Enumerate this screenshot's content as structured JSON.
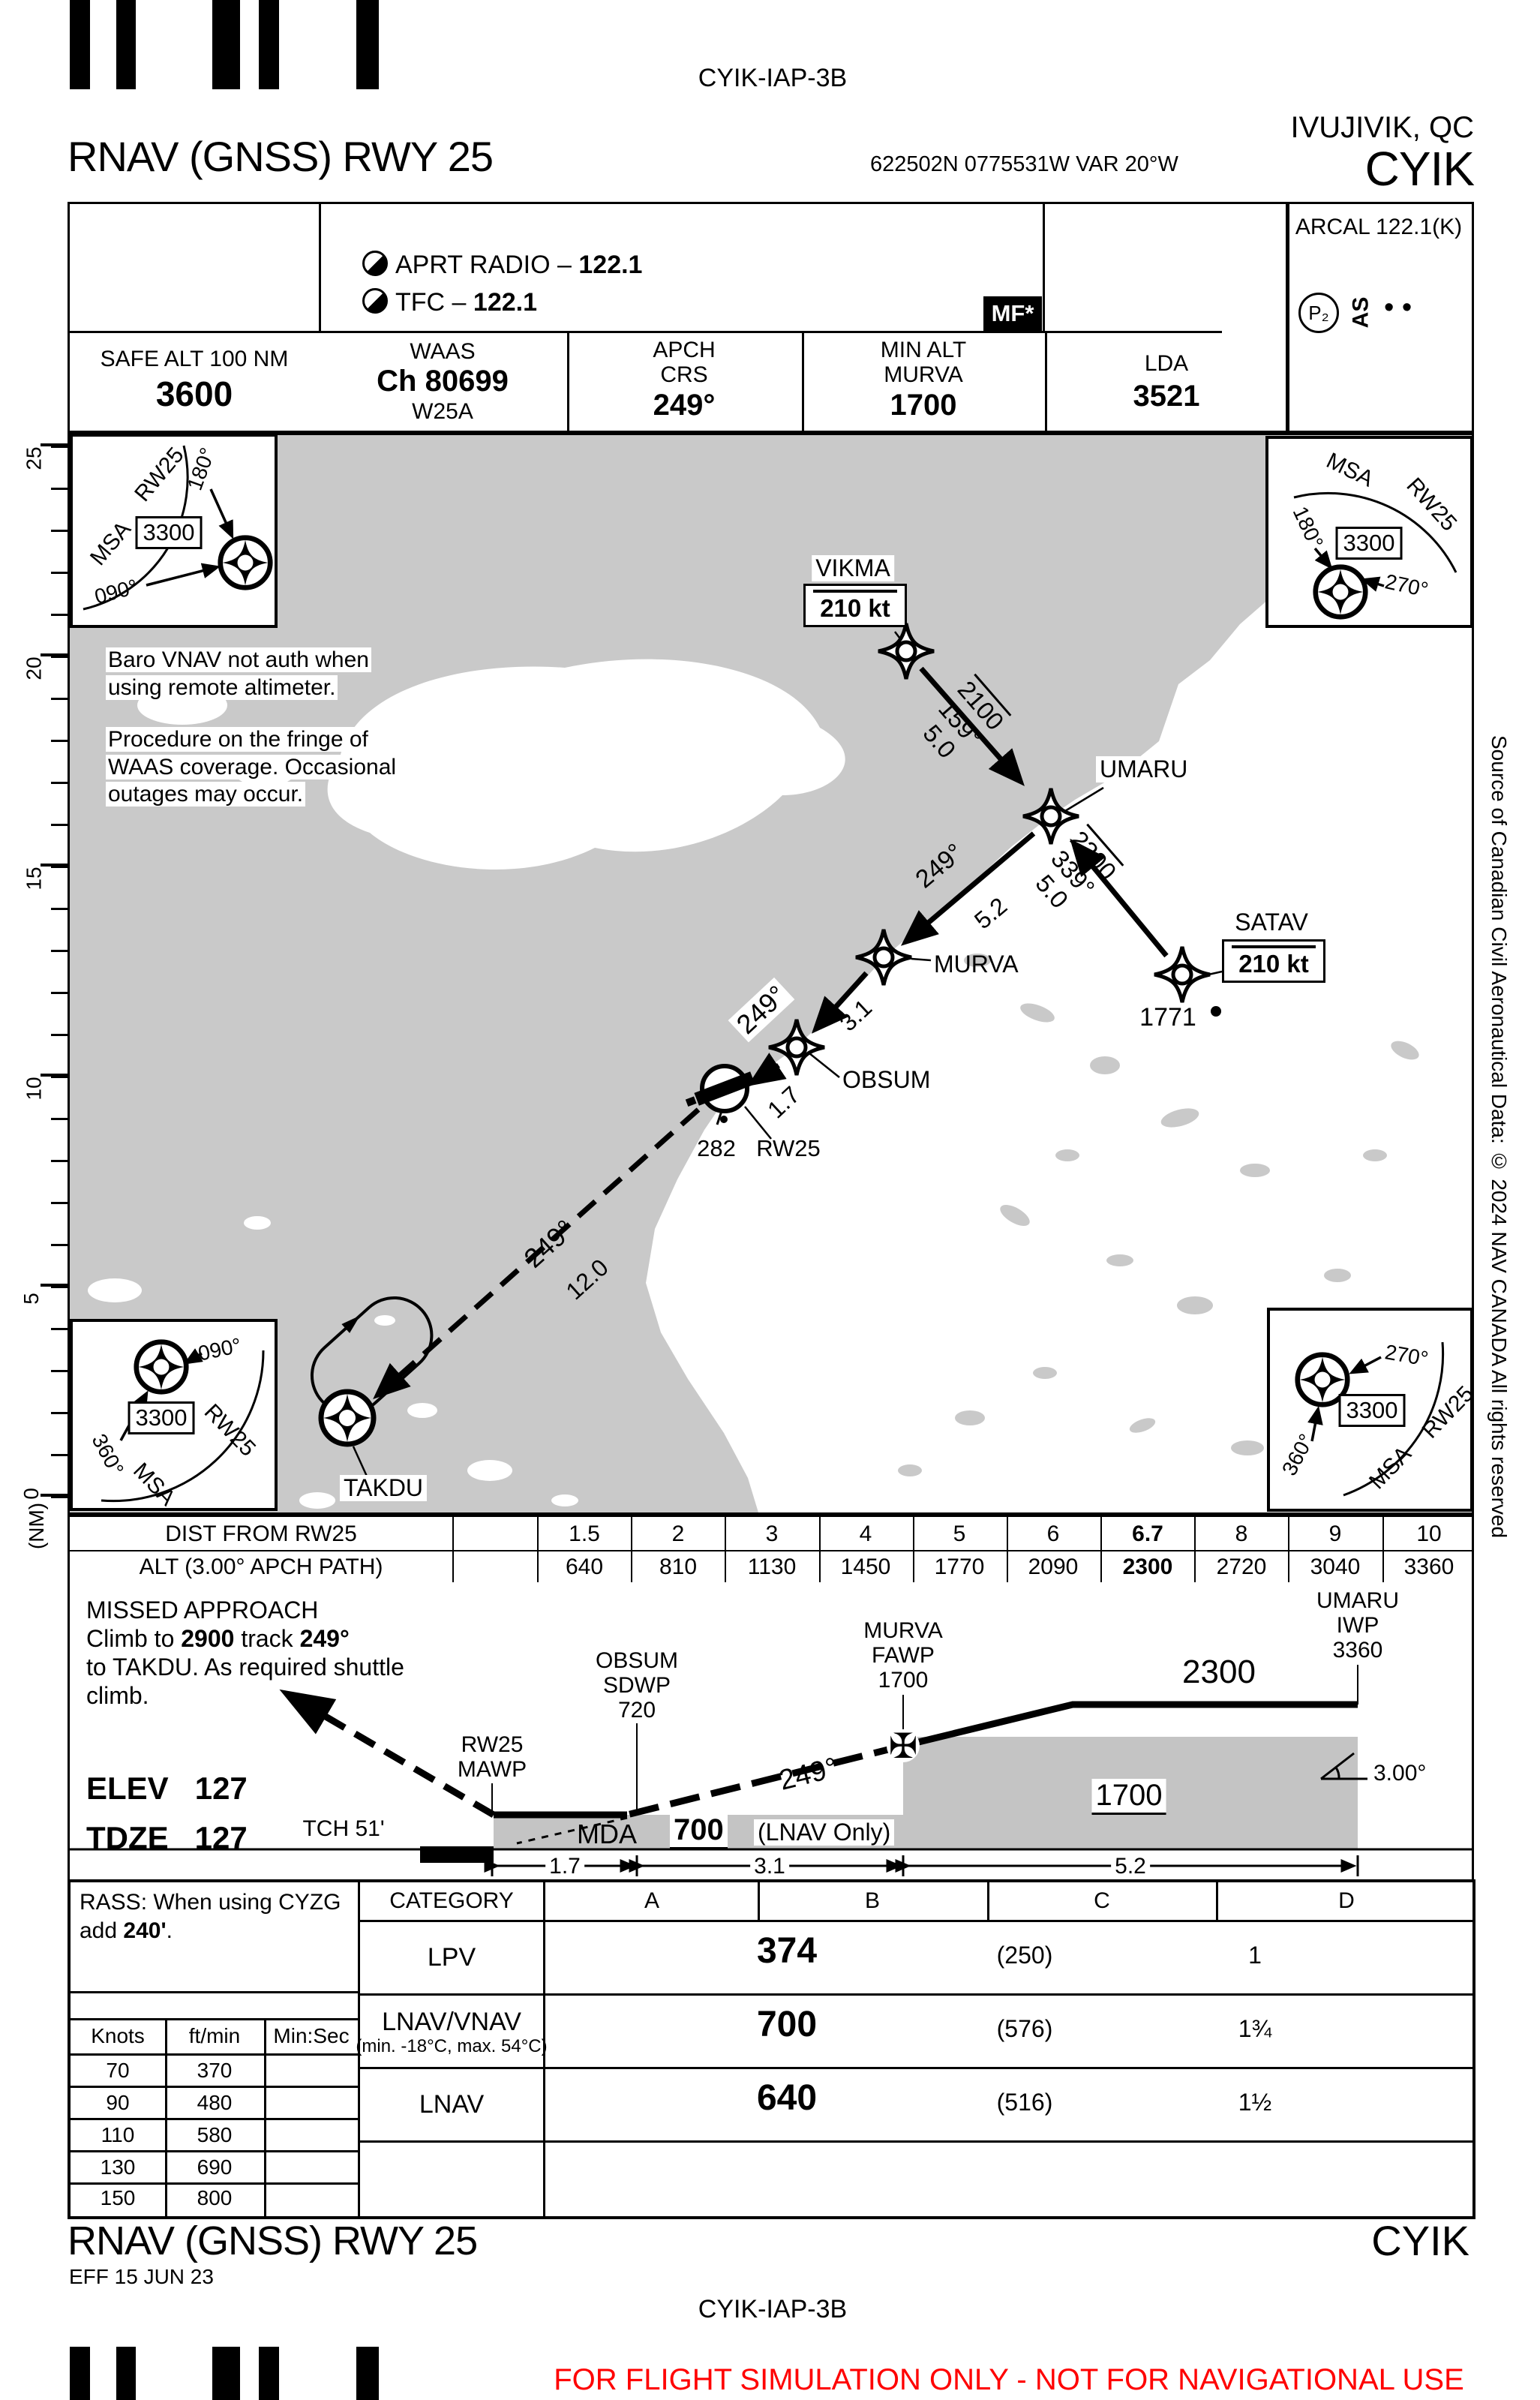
{
  "doc": {
    "top_code": "CYIK-IAP-3B",
    "city": "IVUJIVIK, QC",
    "icao": "CYIK",
    "procedure": "RNAV (GNSS) RWY 25",
    "coords": "622502N  0775531W  VAR 20°W"
  },
  "header_table": {
    "comm1_label": "APRT RADIO – ",
    "comm1_freq": "122.1",
    "comm2_label": "TFC – ",
    "comm2_freq": "122.1",
    "mf": "MF*",
    "arcal": "ARCAL 122.1(K)",
    "p2": "P₂",
    "as": "AS",
    "dots": "• •",
    "safe_label": "SAFE ALT 100 NM",
    "safe_value": "3600",
    "waas_label": "WAAS",
    "waas_ch": "Ch 80699",
    "waas_id": "W25A",
    "apch_l1": "APCH",
    "apch_l2": "CRS",
    "apch_value": "249°",
    "minalt_l1": "MIN ALT",
    "minalt_l2": "MURVA",
    "minalt_value": "1700",
    "lda_label": "LDA",
    "lda_value": "3521"
  },
  "plan": {
    "msa": {
      "title": "MSA",
      "rwy": "RW25",
      "alt": "3300",
      "tl": {
        "b1": "180°",
        "b2": "090°"
      },
      "tr": {
        "b1": "180°",
        "b2": "270°"
      },
      "bl": {
        "b1": "090°",
        "b2": "360°"
      },
      "br": {
        "b1": "270°",
        "b2": "360°"
      }
    },
    "notes": {
      "n1a": "Baro VNAV not auth when",
      "n1b": "using remote altimeter.",
      "n2a": "Procedure on the fringe of",
      "n2b": "WAAS coverage. Occasional",
      "n2c": "outages may occur."
    },
    "wpts": {
      "vikma": "VIKMA",
      "umaru": "UMARU",
      "murva": "MURVA",
      "obsum": "OBSUM",
      "satav": "SATAV",
      "takdu": "TAKDU"
    },
    "speed_restriction": "210 kt",
    "legs": {
      "vikma_umaru": {
        "alt": "2100",
        "crs": "159°",
        "dist": "5.0"
      },
      "satav_umaru": {
        "alt": "2300",
        "crs": "339°",
        "dist": "5.0"
      },
      "umaru_murva": {
        "crs": "249°",
        "dist": "5.2"
      },
      "murva_obsum": {
        "dist": "3.1"
      },
      "obsum_rw": {
        "crs": "249°",
        "dist": "1.7"
      },
      "missed": {
        "crs": "249°",
        "dist": "12.0"
      }
    },
    "rw_label": "RW25",
    "spot_rw": "282",
    "spot_satav": "1771",
    "scale": {
      "unit": "(NM)",
      "l0": "0",
      "l5": "5",
      "l10": "10",
      "l15": "15",
      "l20": "20",
      "l25": "25"
    }
  },
  "dist_table": {
    "r1": "DIST FROM RW25",
    "r2": "ALT (3.00°  APCH PATH)",
    "d": [
      "1.5",
      "2",
      "3",
      "4",
      "5",
      "6",
      "6.7",
      "8",
      "9",
      "10"
    ],
    "a": [
      "640",
      "810",
      "1130",
      "1450",
      "1770",
      "2090",
      "2300",
      "2720",
      "3040",
      "3360"
    ]
  },
  "profile": {
    "ma1": "MISSED APPROACH",
    "ma2a": "Climb to ",
    "ma2b": "2900",
    "ma2c": " track ",
    "ma2d": "249°",
    "ma3": "to TAKDU. As required shuttle",
    "ma4": "climb.",
    "elev_l": "ELEV",
    "elev_v": "127",
    "tdze_l": "TDZE",
    "tdze_v": "127",
    "tch": "TCH 51'",
    "rw_l1": "RW25",
    "rw_l2": "MAWP",
    "obsum_l1": "OBSUM",
    "obsum_l2": "SDWP",
    "obsum_l3": "720",
    "murva_l1": "MURVA",
    "murva_l2": "FAWP",
    "murva_l3": "1700",
    "umaru_l1": "UMARU",
    "umaru_l2": "IWP",
    "umaru_l3": "3360",
    "alt2300": "2300",
    "alt1700": "1700",
    "mda": "MDA",
    "mda_val": "700",
    "lnav_only": "(LNAV Only)",
    "crs": "249°",
    "angle_icon": "∠",
    "angle": "3.00°",
    "faf_icon": "✠",
    "d1": "1.7",
    "d2": "3.1",
    "d3": "5.2"
  },
  "minima": {
    "rass1": "RASS: When using CYZG",
    "rass2a": "add ",
    "rass2b": "240'",
    "rass2c": ".",
    "spd_h": [
      "Knots",
      "ft/min",
      "Min:Sec"
    ],
    "spd_rows": [
      [
        "70",
        "370"
      ],
      [
        "90",
        "480"
      ],
      [
        "110",
        "580"
      ],
      [
        "130",
        "690"
      ],
      [
        "150",
        "800"
      ]
    ],
    "cat": [
      "CATEGORY",
      "A",
      "B",
      "C",
      "D"
    ],
    "rows": [
      {
        "label": "LPV",
        "value": "374",
        "hat": "(250)",
        "vis": "1"
      },
      {
        "label": "LNAV/VNAV",
        "sub": "(min. -18°C, max. 54°C)",
        "value": "700",
        "hat": "(576)",
        "vis": "1¾"
      },
      {
        "label": "LNAV",
        "value": "640",
        "hat": "(516)",
        "vis": "1½"
      }
    ]
  },
  "side_note": "Source of Canadian Civil Aeronautical Data: © 2024 NAV CANADA All rights reserved",
  "footer": {
    "procedure": "RNAV (GNSS) RWY 25",
    "icao": "CYIK",
    "eff": "EFF 15 JUN 23",
    "code": "CYIK-IAP-3B",
    "warning": "FOR FLIGHT SIMULATION ONLY - NOT FOR NAVIGATIONAL USE"
  }
}
